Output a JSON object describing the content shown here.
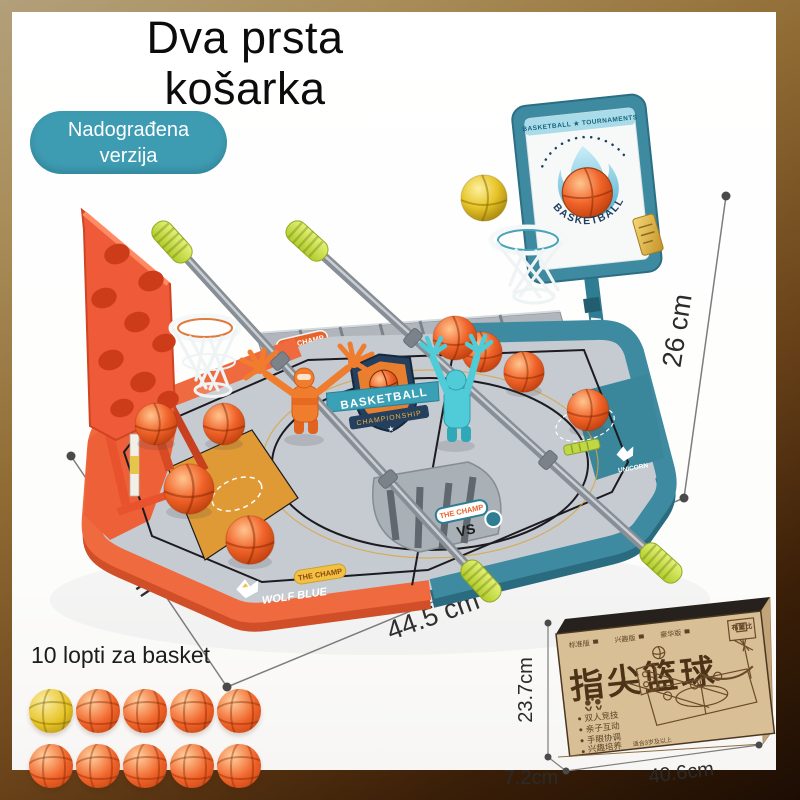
{
  "header": {
    "title_line1": "Dva prsta",
    "title_line2": "košarka",
    "badge_line1": "Nadograđena",
    "badge_line2": "verzija"
  },
  "dimensions": {
    "height_label": "26 cm",
    "depth_label": "59 cm",
    "width_label": "44.5 cm"
  },
  "balls_section": {
    "caption": "10 lopti za basket",
    "count": 10,
    "yellow_color": "#e6c427",
    "orange_color": "#f06329"
  },
  "game": {
    "labels": {
      "champ_back": "THE CHAMP",
      "champ_front": "THE CHAMP",
      "champ_rim": "THE CHAMP",
      "movement": "MOVEMENT",
      "wolf_blue": "WOLF BLUE",
      "unicorn": "UNICORN",
      "vs": "VS",
      "shield_title": "BASKETBALL",
      "shield_subtitle": "CHAMPIONSHIP",
      "board_banner": "BASKETBALL ★ TOURNAMENTS",
      "board_logo": "BASKETBALL",
      "star": "★"
    },
    "colors": {
      "orange": "#ef6a3f",
      "teal": "#3e8ba1",
      "court_gray": "#c6cbd1",
      "handle_green": "#cde14e",
      "rod_gray": "#8f969c",
      "badge_teal": "#3e9cb2"
    }
  },
  "box": {
    "title": "指尖篮球",
    "brand": "布童比",
    "editions": [
      "标准版",
      "兴趣版",
      "豪华版"
    ],
    "features": [
      "双人竞技",
      "亲子互动",
      "手眼协调",
      "兴趣培养"
    ],
    "age_note": "适合3岁及以上",
    "height_label": "23.7cm",
    "depth_label": "7.2cm",
    "width_label": "40.6cm"
  }
}
